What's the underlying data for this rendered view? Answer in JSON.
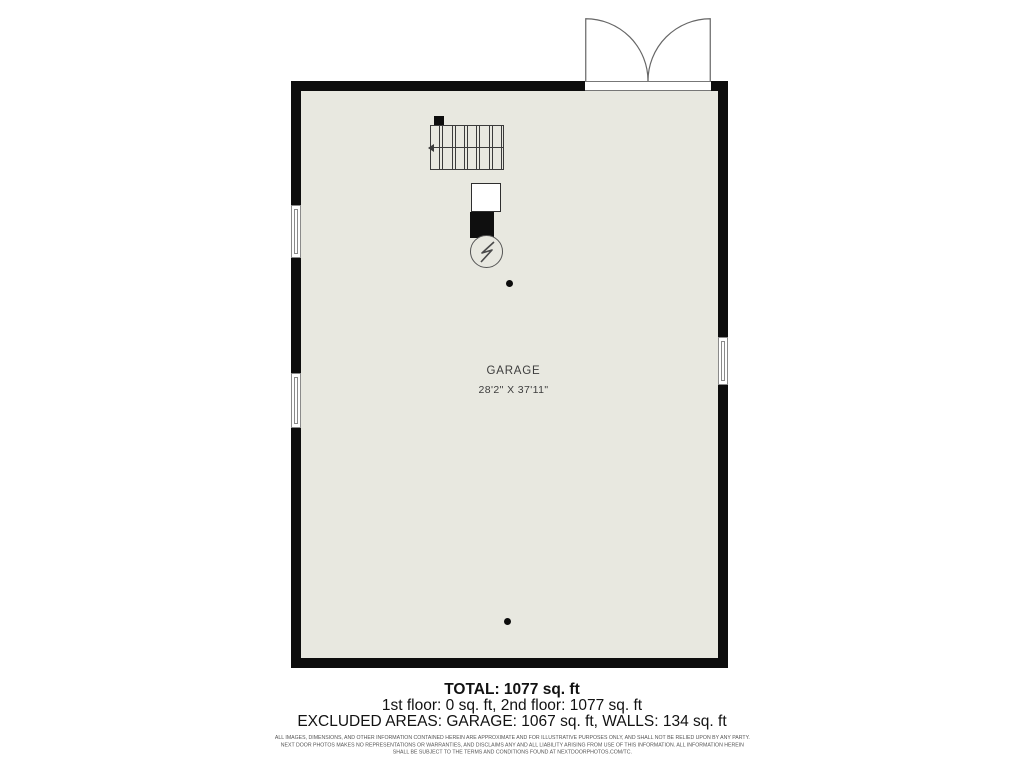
{
  "plan": {
    "room": {
      "name": "GARAGE",
      "dimensions": "28'2\" X 37'11\""
    },
    "icons": {
      "door": "double-door-swing",
      "window": "double-hung-window",
      "stairs": "staircase-up-arrow",
      "furnace": "furnace-unit",
      "water_heater": "water-heater-bolt-circle",
      "column": "support-column-dot"
    },
    "colors": {
      "wall": "#0d0d0d",
      "floor": "#e8e8e0",
      "line": "#3b3b3b"
    }
  },
  "summary": {
    "total": "TOTAL: 1077 sq. ft",
    "floors": "1st floor: 0 sq. ft, 2nd floor: 1077 sq. ft",
    "excluded": "EXCLUDED AREAS: GARAGE: 1067 sq. ft, WALLS: 134 sq. ft"
  },
  "disclaimer": {
    "line1": "ALL IMAGES, DIMENSIONS, AND OTHER INFORMATION CONTAINED HEREIN ARE APPROXIMATE AND FOR ILLUSTRATIVE PURPOSES ONLY, AND SHALL NOT BE RELIED UPON BY ANY PARTY.",
    "line2": "NEXT DOOR PHOTOS MAKES NO REPRESENTATIONS OR WARRANTIES, AND DISCLAIMS ANY AND ALL LIABILITY ARISING FROM USE OF THIS INFORMATION. ALL INFORMATION HEREIN",
    "line3": "SHALL BE SUBJECT TO THE TERMS AND CONDITIONS FOUND AT NEXTDOORPHOTOS.COM/TC."
  }
}
